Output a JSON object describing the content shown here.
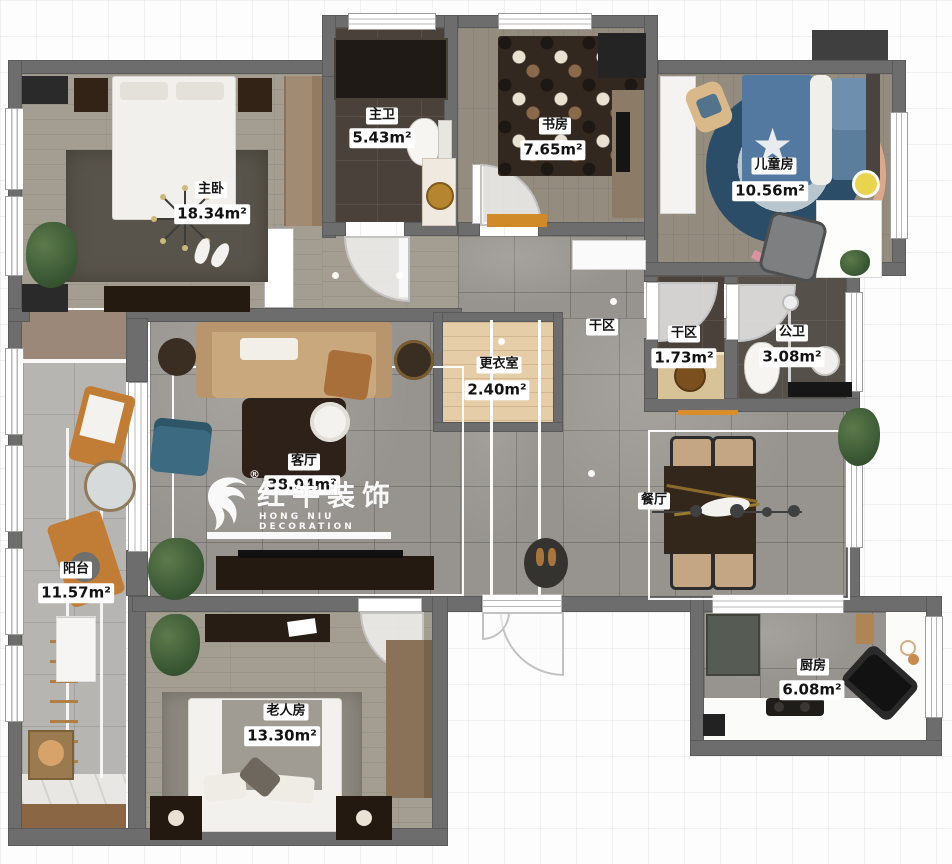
{
  "plan": {
    "brand": {
      "name_cn": "红牛装饰",
      "name_en": "HONG NIU DECORATION",
      "registered": "®"
    },
    "rooms": [
      {
        "id": "master-bedroom",
        "name": "主卧",
        "area": "18.34m²"
      },
      {
        "id": "master-bath",
        "name": "主卫",
        "area": "5.43m²"
      },
      {
        "id": "study",
        "name": "书房",
        "area": "7.65m²"
      },
      {
        "id": "kids-room",
        "name": "儿童房",
        "area": "10.56m²"
      },
      {
        "id": "dry-area-hall",
        "name": "干区",
        "area": ""
      },
      {
        "id": "dry-area",
        "name": "干区",
        "area": "1.73m²"
      },
      {
        "id": "public-bath",
        "name": "公卫",
        "area": "3.08m²"
      },
      {
        "id": "dressing-room",
        "name": "更衣室",
        "area": "2.40m²"
      },
      {
        "id": "living-room",
        "name": "客厅",
        "area": "38.94m²"
      },
      {
        "id": "dining-room",
        "name": "餐厅",
        "area": ""
      },
      {
        "id": "balcony",
        "name": "阳台",
        "area": "11.57m²"
      },
      {
        "id": "elder-room",
        "name": "老人房",
        "area": "13.30m²"
      },
      {
        "id": "kitchen",
        "name": "厨房",
        "area": "6.08m²"
      }
    ],
    "palette": {
      "wall": "#6d6d6d",
      "marble": "#97948f",
      "wood": "#a49e92",
      "dark_tile": "#4a423a",
      "balcony_tile": "#b7b5b1",
      "dressing_wood": "#e5cda7",
      "accent_orange": "#d98e2b",
      "bed_blue": "#5379a1",
      "rug_navy": "#2c4d68"
    }
  }
}
